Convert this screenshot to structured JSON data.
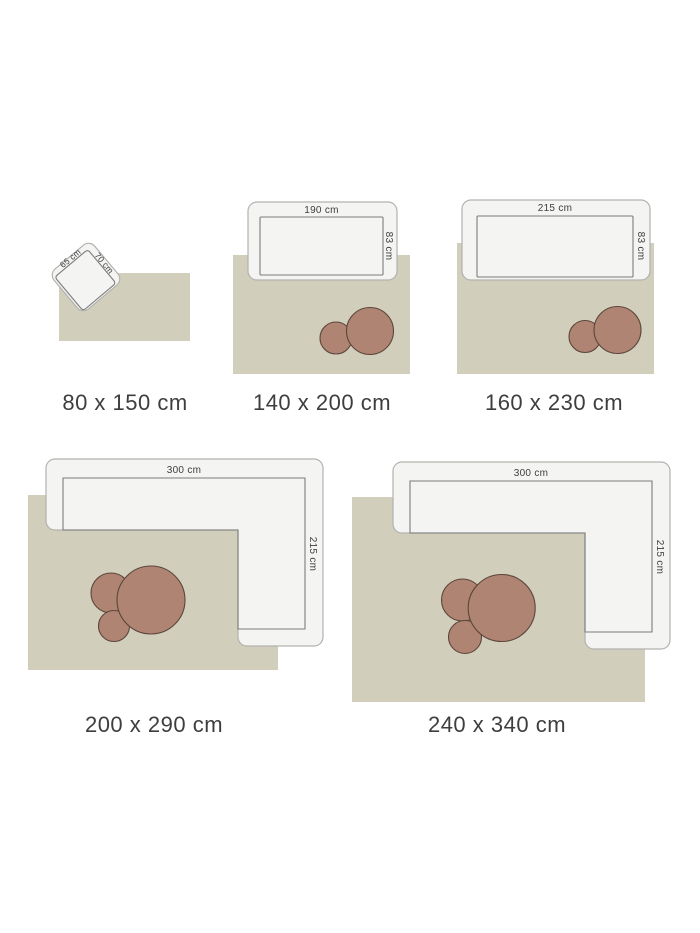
{
  "colors": {
    "background": "#ffffff",
    "rug": "#d1cebb",
    "furniture_fill": "#f4f4f2",
    "furniture_border": "#b2b2b0",
    "seat_line": "#7d7d7c",
    "ottoman_fill": "#b08472",
    "ottoman_border": "#5c463c",
    "label_text": "#3e3e3e"
  },
  "diagrams": [
    {
      "size_label": "80 x 150 cm",
      "furniture": {
        "type": "armchair",
        "width_label": "65 cm",
        "depth_label": "70 cm"
      },
      "ottoman_count": 0
    },
    {
      "size_label": "140 x 200 cm",
      "furniture": {
        "type": "sofa",
        "width_label": "190 cm",
        "depth_label": "83 cm"
      },
      "ottoman_count": 2
    },
    {
      "size_label": "160 x 230 cm",
      "furniture": {
        "type": "sofa",
        "width_label": "215 cm",
        "depth_label": "83 cm"
      },
      "ottoman_count": 2
    },
    {
      "size_label": "200 x 290 cm",
      "furniture": {
        "type": "corner-sofa",
        "width_label": "300 cm",
        "depth_label": "215 cm"
      },
      "ottoman_count": 3
    },
    {
      "size_label": "240 x 340 cm",
      "furniture": {
        "type": "corner-sofa",
        "width_label": "300 cm",
        "depth_label": "215 cm"
      },
      "ottoman_count": 3
    }
  ]
}
